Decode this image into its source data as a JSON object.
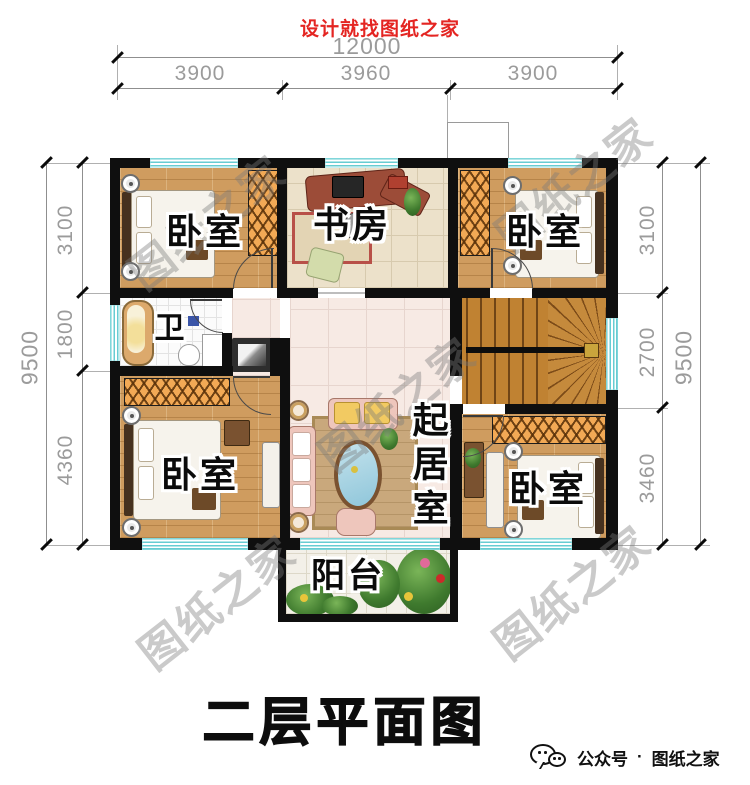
{
  "header": {
    "slogan": "设计就找图纸之家"
  },
  "dims": {
    "top_total": "12000",
    "top_segs": [
      "3900",
      "3960",
      "3900"
    ],
    "left_total": "9500",
    "left_segs": [
      "3100",
      "1800",
      "4360"
    ],
    "right_total": "9500",
    "right_segs": [
      "3100",
      "2700",
      "3460"
    ]
  },
  "rooms": {
    "bedroom_tl": "卧室",
    "study": "书房",
    "bedroom_tr": "卧室",
    "bath": "卫",
    "living": "起居室",
    "bedroom_bl": "卧室",
    "bedroom_br": "卧室",
    "balcony": "阳台"
  },
  "title": "二层平面图",
  "watermark": "图纸之家",
  "footer": {
    "label": "公众号",
    "separator": "·",
    "brand": "图纸之家"
  },
  "colors": {
    "accent_red": "#e42522",
    "wall_black": "#0f0f0f",
    "window_teal": "#67ccd2",
    "wood_floor": "#cf9c5f",
    "stair_wood": "#c08232",
    "wardrobe_orange": "#f2a955"
  }
}
